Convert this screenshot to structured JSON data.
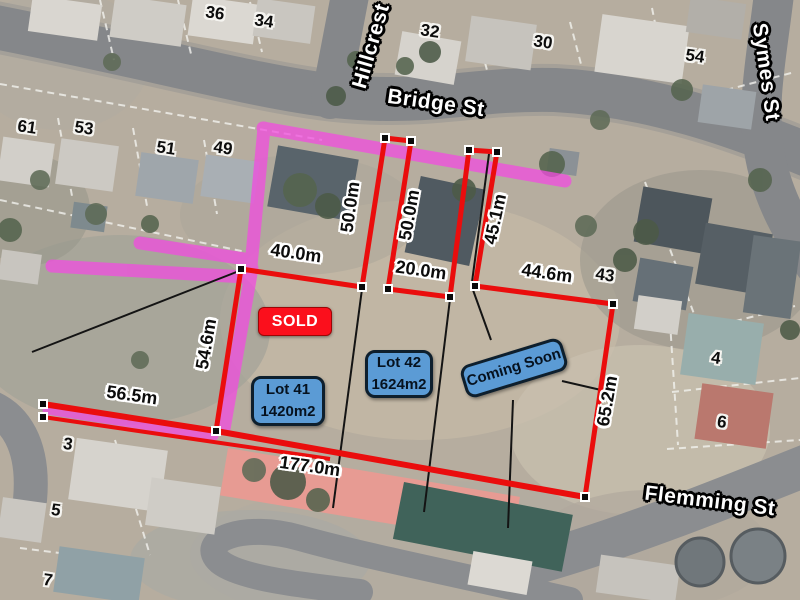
{
  "map": {
    "type": "aerial-real-estate-lot-map",
    "streets": [
      {
        "id": "hillcrest",
        "label": "Hillcrest"
      },
      {
        "id": "bridge",
        "label": "Bridge St"
      },
      {
        "id": "symes",
        "label": "Symes St"
      },
      {
        "id": "flemming",
        "label": "Flemming St"
      }
    ],
    "houses": [
      {
        "label": "36"
      },
      {
        "label": "34"
      },
      {
        "label": "32"
      },
      {
        "label": "30"
      },
      {
        "label": "54"
      },
      {
        "label": "61"
      },
      {
        "label": "53"
      },
      {
        "label": "51"
      },
      {
        "label": "49"
      },
      {
        "label": "43"
      },
      {
        "label": "4"
      },
      {
        "label": "6"
      },
      {
        "label": "3"
      },
      {
        "label": "5"
      },
      {
        "label": "7"
      }
    ],
    "measurements": [
      {
        "label": "50.0m"
      },
      {
        "label": "50.0m"
      },
      {
        "label": "45.1m"
      },
      {
        "label": "40.0m"
      },
      {
        "label": "20.0m"
      },
      {
        "label": "44.6m"
      },
      {
        "label": "54.6m"
      },
      {
        "label": "56.5m"
      },
      {
        "label": "65.2m"
      },
      {
        "label": "177.0m"
      }
    ],
    "boxes": {
      "sold": "SOLD",
      "lot41": {
        "name": "Lot 41",
        "area": "1420m2"
      },
      "lot42": {
        "name": "Lot 42",
        "area": "1624m2"
      },
      "coming_soon": "Coming Soon"
    },
    "colors": {
      "boundary_red": "#ea0d0d",
      "highlight_magenta": "#f24ce0",
      "lot_box_blue": "#5b9bd5",
      "sold_red": "#fb0f1c",
      "marker_black": "#0a0a0a",
      "marker_white": "#ffffff"
    }
  }
}
